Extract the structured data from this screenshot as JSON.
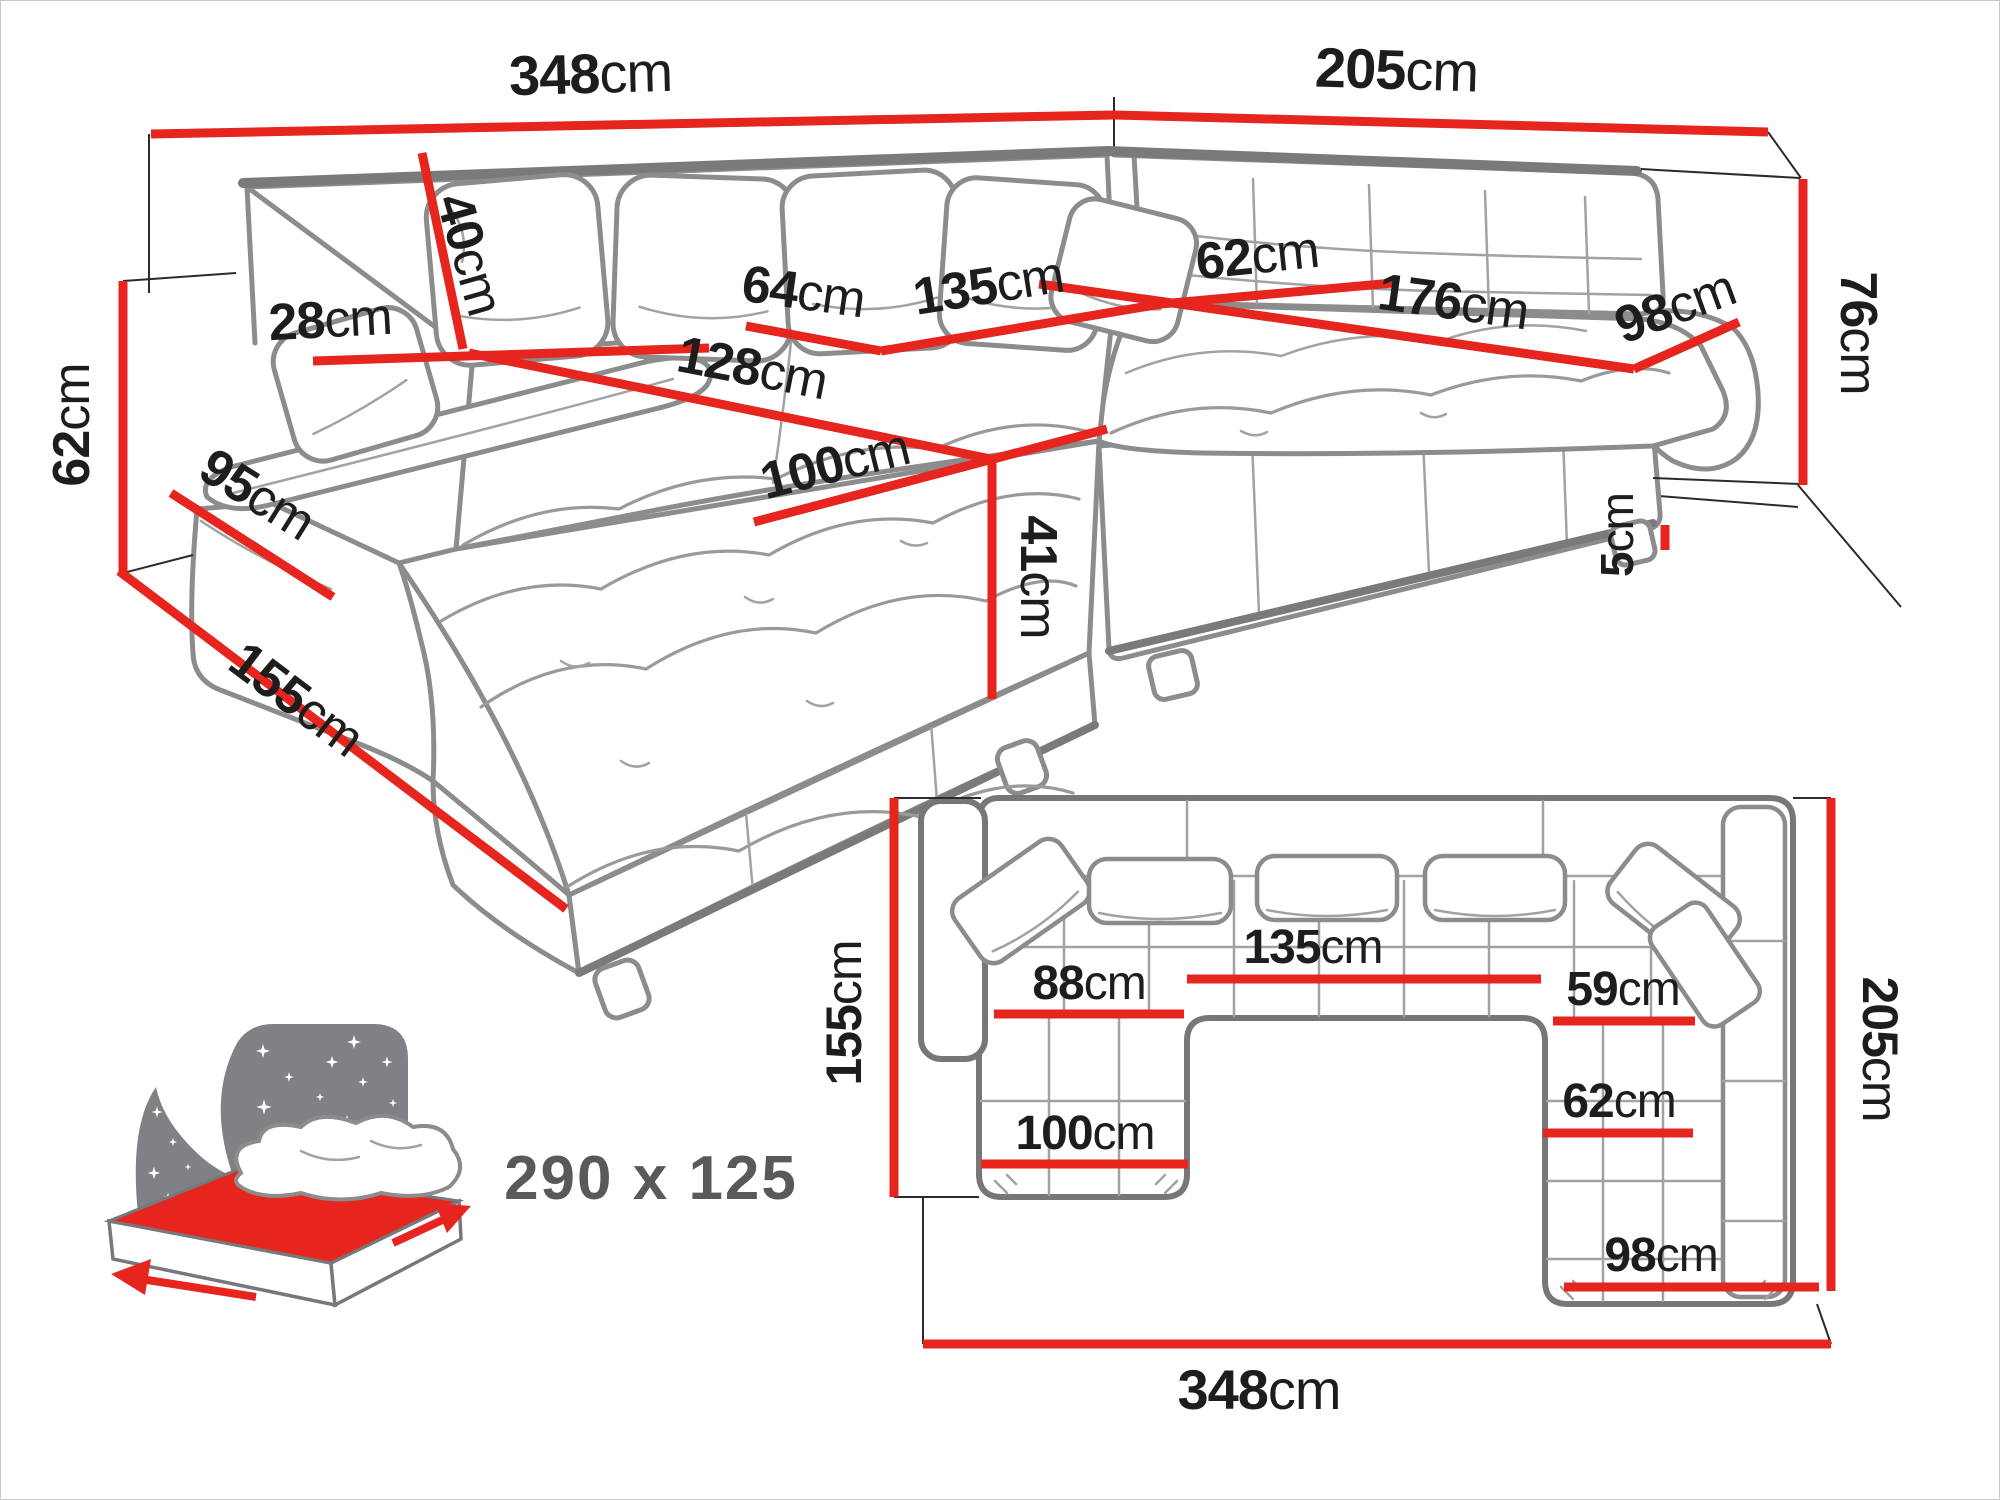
{
  "diagram": {
    "kind": "furniture dimension diagram",
    "subject": "U-shaped corner sofa with sleeping function",
    "unit": "cm"
  },
  "colors": {
    "dimension_red": "#e6251f",
    "sketch_gray": "#8c8c8c",
    "rim_gray": "#7a7a7a",
    "label_black": "#1d1d1b",
    "icon_gray": "#7f8184",
    "bed_text_gray": "#58595b"
  },
  "perspective_view": {
    "dims": {
      "total_width": {
        "value": "348",
        "unit": "cm"
      },
      "right_depth": {
        "value": "205",
        "unit": "cm"
      },
      "arm_height": {
        "value": "62",
        "unit": "cm"
      },
      "arm_side_length": {
        "value": "95",
        "unit": "cm"
      },
      "chaise_total": {
        "value": "155",
        "unit": "cm"
      },
      "arm_top_width": {
        "value": "28",
        "unit": "cm"
      },
      "back_cushion": {
        "value": "40",
        "unit": "cm"
      },
      "seat_depth": {
        "value": "64",
        "unit": "cm"
      },
      "middle_seat_width": {
        "value": "135",
        "unit": "cm"
      },
      "chaise_inner": {
        "value": "128",
        "unit": "cm"
      },
      "corner_seat": {
        "value": "62",
        "unit": "cm"
      },
      "right_seat_length": {
        "value": "176",
        "unit": "cm"
      },
      "right_end_width": {
        "value": "98",
        "unit": "cm"
      },
      "total_height": {
        "value": "76",
        "unit": "cm"
      },
      "chaise_width": {
        "value": "100",
        "unit": "cm"
      },
      "seat_height": {
        "value": "41",
        "unit": "cm"
      },
      "leg_height": {
        "value": "5",
        "unit": "cm"
      }
    }
  },
  "top_view": {
    "dims": {
      "left_depth": {
        "value": "155",
        "unit": "cm"
      },
      "right_depth": {
        "value": "205",
        "unit": "cm"
      },
      "total_width": {
        "value": "348",
        "unit": "cm"
      },
      "left_seat": {
        "value": "88",
        "unit": "cm"
      },
      "middle_seat": {
        "value": "135",
        "unit": "cm"
      },
      "right_seat": {
        "value": "59",
        "unit": "cm"
      },
      "right_chaise": {
        "value": "62",
        "unit": "cm"
      },
      "left_chaise": {
        "value": "100",
        "unit": "cm"
      },
      "right_end": {
        "value": "98",
        "unit": "cm"
      }
    }
  },
  "sleeping_area": {
    "label": "290 x 125"
  }
}
